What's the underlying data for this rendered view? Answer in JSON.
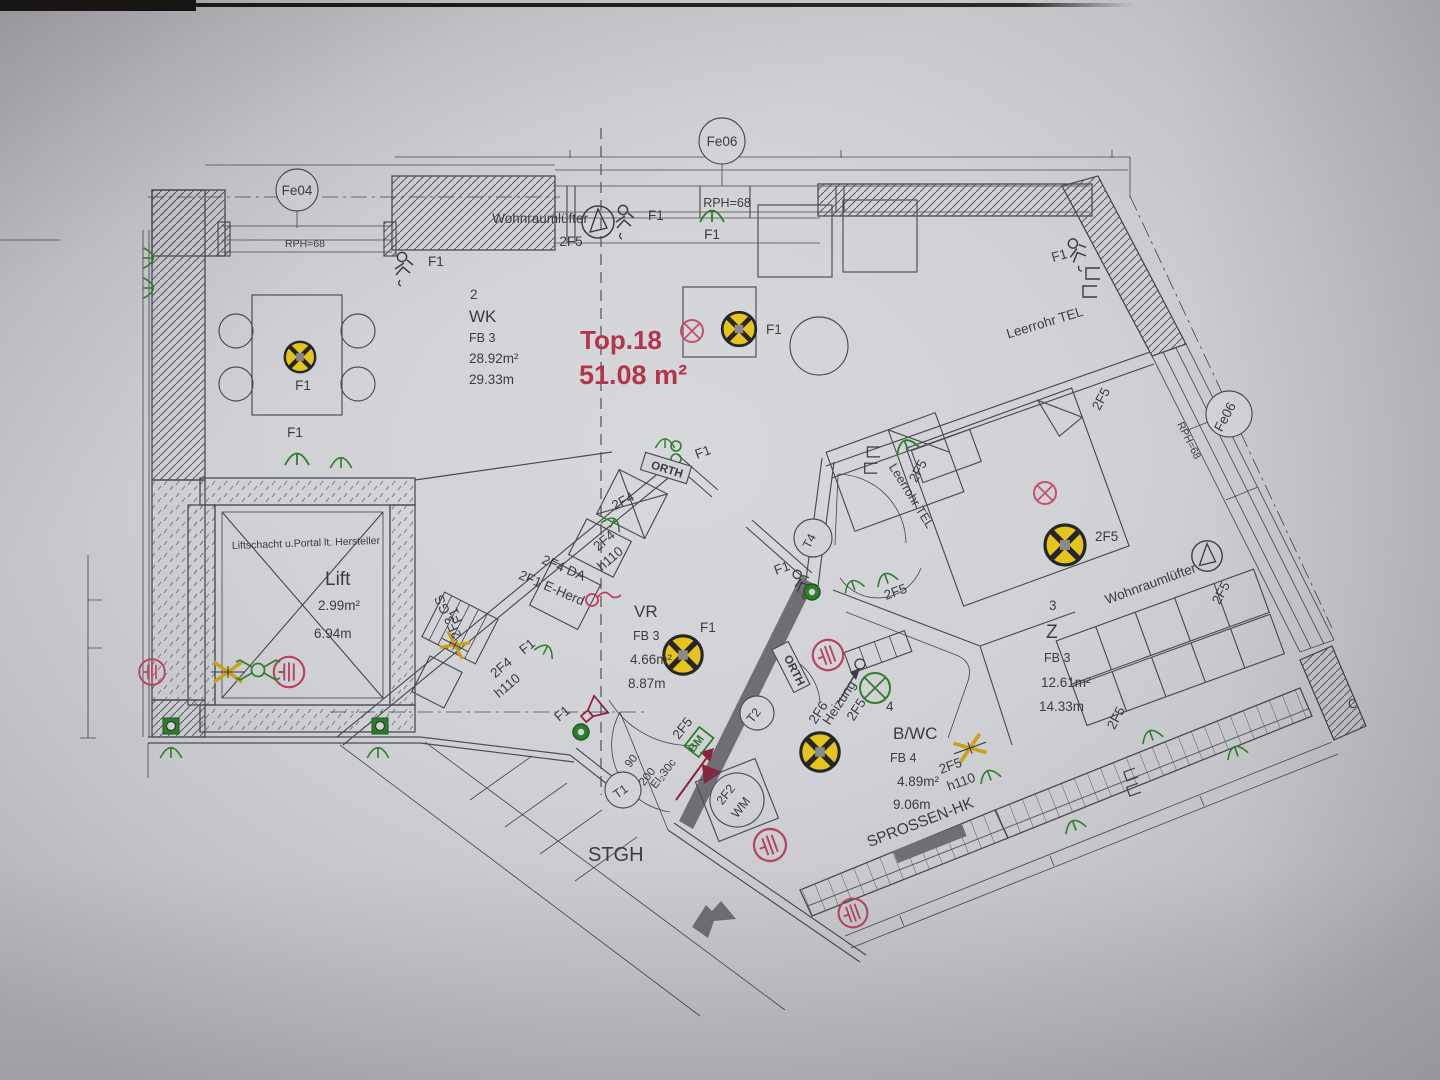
{
  "title": {
    "top": "Top.18",
    "area": "51.08 m²"
  },
  "windows": {
    "fe04": "Fe04",
    "fe06_top": "Fe06",
    "fe06_right": "Fe06",
    "rph_left": "RPH=68",
    "rph_top": "RPH=68",
    "rph_right": "RPH=68"
  },
  "rooms": {
    "wk": {
      "num": "2",
      "name": "WK",
      "fb": "FB 3",
      "area": "28.92m²",
      "per": "29.33m"
    },
    "vr": {
      "name": "VR",
      "fb": "FB 3",
      "area": "4.66m²",
      "per": "8.87m"
    },
    "z": {
      "num": "3",
      "name": "Z",
      "fb": "FB 3",
      "area": "12.61m²",
      "per": "14.33m"
    },
    "bwc": {
      "num": "4",
      "name": "B/WC",
      "fb": "FB 4",
      "area": "4.89m²",
      "per": "9.06m"
    },
    "lift": {
      "name": "Lift",
      "area": "2.99m²",
      "per": "6.94m",
      "note": "Liftschacht u.Portal lt. Hersteller"
    }
  },
  "labels": {
    "f1": "F1",
    "f5": "2F5",
    "f4": "2F4",
    "h110": "h110",
    "f4da": "2F4 DA",
    "f1herd": "2F1 E-Herd",
    "f3gs": "2F3 GS",
    "f6": "2F6",
    "heizung": "Heizung",
    "f2": "2F2",
    "wm": "WM",
    "bm": "BM",
    "orth": "ORTH",
    "stgh": "STGH",
    "sprossen": "SPROSSEN-HK",
    "wohnraumluefter": "Wohnraumlüfter",
    "leerrohr": "Leerrohr TEL",
    "t1": "T1",
    "t2": "T2",
    "t4": "T4",
    "fire": "EI₂30c",
    "dim200": "200",
    "dim90": "90.",
    "section_c": "C"
  },
  "colors": {
    "line": "#4a4a52",
    "green": "#2e7d2e",
    "red": "#bf4166",
    "accent_red": "#b23549",
    "yellow": "#e5c51d",
    "wall_dark": "#6f6f73"
  }
}
